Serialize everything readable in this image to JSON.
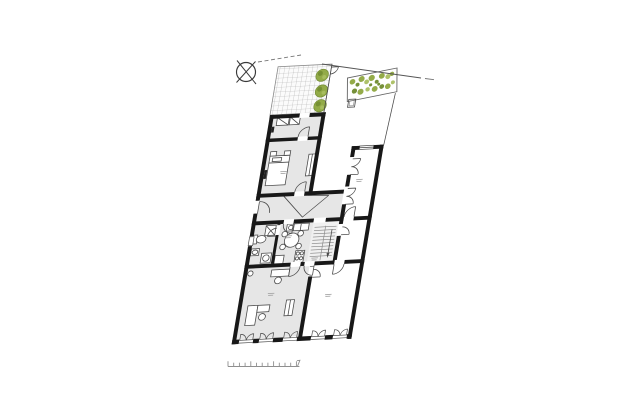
{
  "document": {
    "type": "architectural-floor-plan",
    "visible_text": [],
    "rooms": [
      "terrace",
      "garden-bed",
      "courtyard",
      "storage-room",
      "bedroom",
      "hallway",
      "bathroom",
      "kitchen-dining",
      "office",
      "staircase",
      "upper-right-room",
      "middle-right-room",
      "lower-right-room"
    ]
  },
  "palette": {
    "bg": "#ffffff",
    "wall": "#181818",
    "line": "#4a4a4a",
    "line_light": "#8c8c8c",
    "floor": "#e6e6e6",
    "floor_light": "#f0f0f0",
    "tile_grout": "#a9a9a9",
    "tile_bg": "#fbfbfb",
    "green": "#8ea73f",
    "green_dark": "#6f8a2e",
    "green_light": "#aabf61",
    "scalebar": "#8f8f8f",
    "label": "#a6a6a6",
    "boundary": "#777777"
  },
  "compass": {
    "cx": 246,
    "cy": 72,
    "r": 9.5
  },
  "boundary": {
    "dashed": [
      [
        258,
        62
      ],
      [
        301,
        55
      ]
    ],
    "solid": [
      [
        322,
        64
      ],
      [
        421,
        78
      ]
    ],
    "end_dash": [
      [
        425,
        78.5
      ],
      [
        434,
        79.7
      ]
    ]
  },
  "scalebar": {
    "x": 228,
    "y_base": 366.5,
    "tick_count": 13,
    "tick_spacing": 5.7,
    "tick_h": 3.8,
    "tick_h_major": 5.2,
    "major_every": 4
  },
  "plan_transform": {
    "matrix": [
      0.998,
      -0.05,
      -0.165,
      0.986,
      272,
      115
    ]
  },
  "terrace": {
    "bushes": [
      [
        44,
        -38
      ],
      [
        46,
        -22
      ],
      [
        47,
        -7
      ]
    ]
  },
  "garden_bed": {
    "origin": [
      70,
      -34
    ],
    "rotation_deg": -9,
    "size": [
      49,
      24.5
    ],
    "dots": [
      [
        5,
        5,
        2.8,
        "green"
      ],
      [
        10,
        9,
        2.0,
        "green_dark"
      ],
      [
        14,
        4,
        3.0,
        "green"
      ],
      [
        19,
        8,
        2.4,
        "green_light"
      ],
      [
        24,
        5,
        3.1,
        "green"
      ],
      [
        29,
        10,
        2.0,
        "green_dark"
      ],
      [
        34,
        5,
        2.9,
        "green"
      ],
      [
        40,
        7,
        2.5,
        "green_light"
      ],
      [
        44,
        5,
        2.2,
        "green"
      ],
      [
        7,
        15,
        2.6,
        "green_dark"
      ],
      [
        13,
        17,
        3.0,
        "green"
      ],
      [
        20,
        16,
        2.2,
        "green_light"
      ],
      [
        27,
        17,
        2.9,
        "green"
      ],
      [
        34,
        16,
        2.4,
        "green_dark"
      ],
      [
        40,
        17,
        2.8,
        "green"
      ],
      [
        45,
        14,
        2.0,
        "green_light"
      ],
      [
        23,
        12,
        1.6,
        "green_dark"
      ],
      [
        31,
        13,
        1.5,
        "green_dark"
      ]
    ]
  },
  "bottom_windows": {
    "centers": [
      12,
      32,
      56,
      84,
      106
    ]
  },
  "stairs": {
    "x1": 62,
    "x2": 84,
    "y_start": 117,
    "tread_count": 10,
    "spacing": 3.3
  },
  "room_label_marks": [
    [
      18,
      58
    ],
    [
      34,
      124
    ],
    [
      26,
      182
    ],
    [
      96,
      70
    ],
    [
      84,
      186
    ],
    [
      64,
      148
    ]
  ],
  "dimension_marks": [
    [
      -1,
      96
    ],
    [
      -1,
      103
    ],
    [
      115,
      140
    ],
    [
      115,
      147
    ]
  ]
}
